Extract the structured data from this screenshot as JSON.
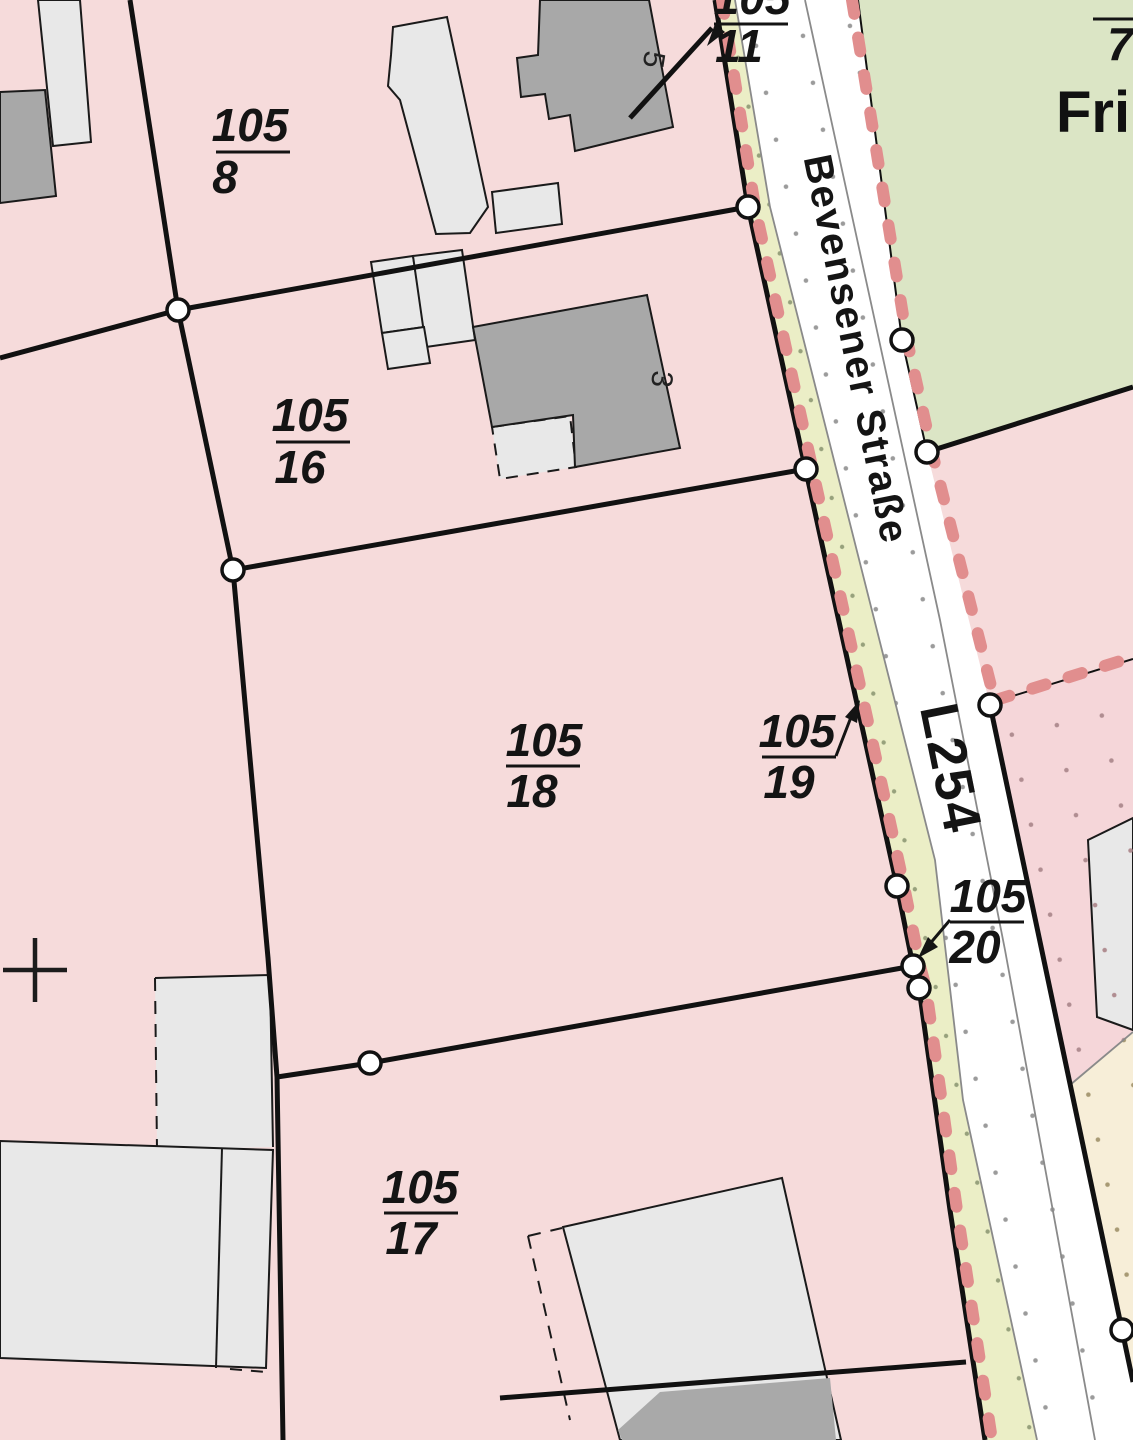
{
  "map": {
    "street": {
      "name": "Bevensener Straße",
      "route_number": "L254"
    },
    "green_area_label_partial": "Fri",
    "top_right_parcel_partial": "7",
    "house_numbers": {
      "h5": "5",
      "h3": "3"
    },
    "parcel_labels": {
      "p8": {
        "num": "105",
        "den": "8"
      },
      "p11": {
        "num": "105",
        "den": "11"
      },
      "p16": {
        "num": "105",
        "den": "16"
      },
      "p17": {
        "num": "105",
        "den": "17"
      },
      "p18": {
        "num": "105",
        "den": "18"
      },
      "p19": {
        "num": "105",
        "den": "19"
      },
      "p20": {
        "num": "105",
        "den": "20"
      }
    },
    "colors": {
      "parcel_pink": "#f6dbdb",
      "parcel_pink_dotted": "#f5d6d9",
      "green_area": "#dbe5c5",
      "road_white": "#ffffff",
      "verge_yellow": "#ebeec6",
      "cream_area": "#f7eed8",
      "boundary_red_dash": "#e18e8e",
      "building_light": "#e8e8e8",
      "building_dark": "#a8a8a8",
      "line_black": "#111111"
    }
  }
}
